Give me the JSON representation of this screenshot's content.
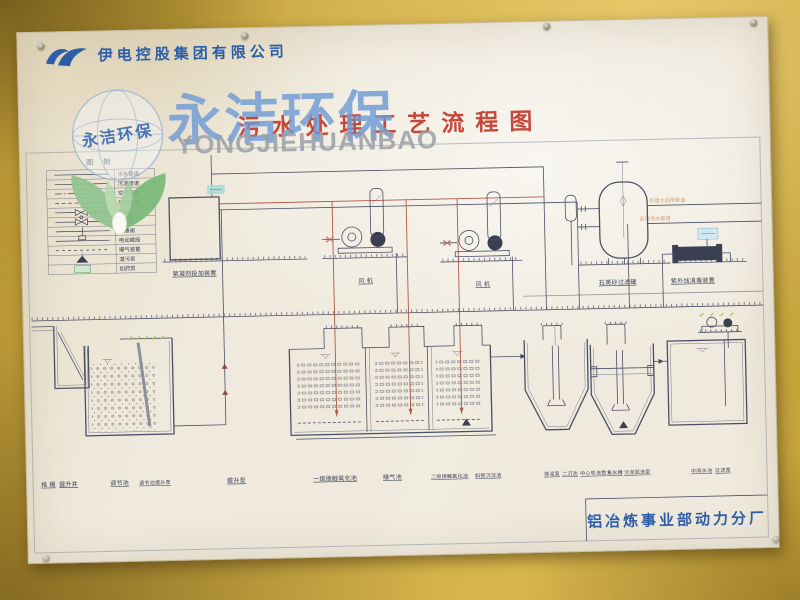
{
  "company": {
    "name": "伊电控股集团有限公司"
  },
  "title": {
    "text": "污水处理工艺流程图"
  },
  "watermark": {
    "cn": "永洁环保",
    "en": "YONGJIEHUANBAO",
    "seal": "永洁环保"
  },
  "footer": {
    "department": "铝冶炼事业部动力分厂"
  },
  "legend": {
    "title": "图 例",
    "rows": [
      {
        "label": "污水管道"
      },
      {
        "label": "污泥管道"
      },
      {
        "label": "空气管道"
      },
      {
        "label": "加药管道"
      },
      {
        "label": "闸阀"
      },
      {
        "label": "止回阀"
      },
      {
        "label": "三通阀"
      },
      {
        "label": "电动蝶阀"
      },
      {
        "label": "曝气装置"
      },
      {
        "label": "潜污泵"
      },
      {
        "label": "加药泵"
      }
    ]
  },
  "diagram": {
    "equipment_labels": [
      {
        "text": "絮凝剂投加装置"
      },
      {
        "text": "风 机"
      },
      {
        "text": "风 机"
      },
      {
        "text": "石英砂过滤罐"
      },
      {
        "text": "紫外线消毒装置"
      }
    ],
    "tank_labels": [
      {
        "text": "格 栅"
      },
      {
        "text": "提升井"
      },
      {
        "text": "调节池"
      },
      {
        "text": "调节池提升泵"
      },
      {
        "text": "提升泵"
      },
      {
        "text": "一级接触氧化池"
      },
      {
        "text": "曝气池"
      },
      {
        "text": "二级接触氧化池"
      },
      {
        "text": "斜管沉淀池"
      },
      {
        "text": "排泥泵"
      },
      {
        "text": "二沉池"
      },
      {
        "text": "中心导流筒"
      },
      {
        "text": "集水槽"
      },
      {
        "text": "污泥回流泵"
      },
      {
        "text": "中间水池"
      },
      {
        "text": "过滤泵"
      }
    ],
    "pipe_notes": [
      {
        "text": "处理水回用管道"
      },
      {
        "text": "反冲洗水管道"
      }
    ]
  },
  "colors": {
    "wall": "#c9a83e",
    "poster": "#efeadd",
    "line": "#4b5066",
    "dosing_pipe_red": "#b2584c",
    "title_red": "#c23a2c",
    "brand_blue": "#2d5ea7",
    "watermark_blue": "#6f9bd6",
    "leaf_green": "#7ab97a"
  }
}
